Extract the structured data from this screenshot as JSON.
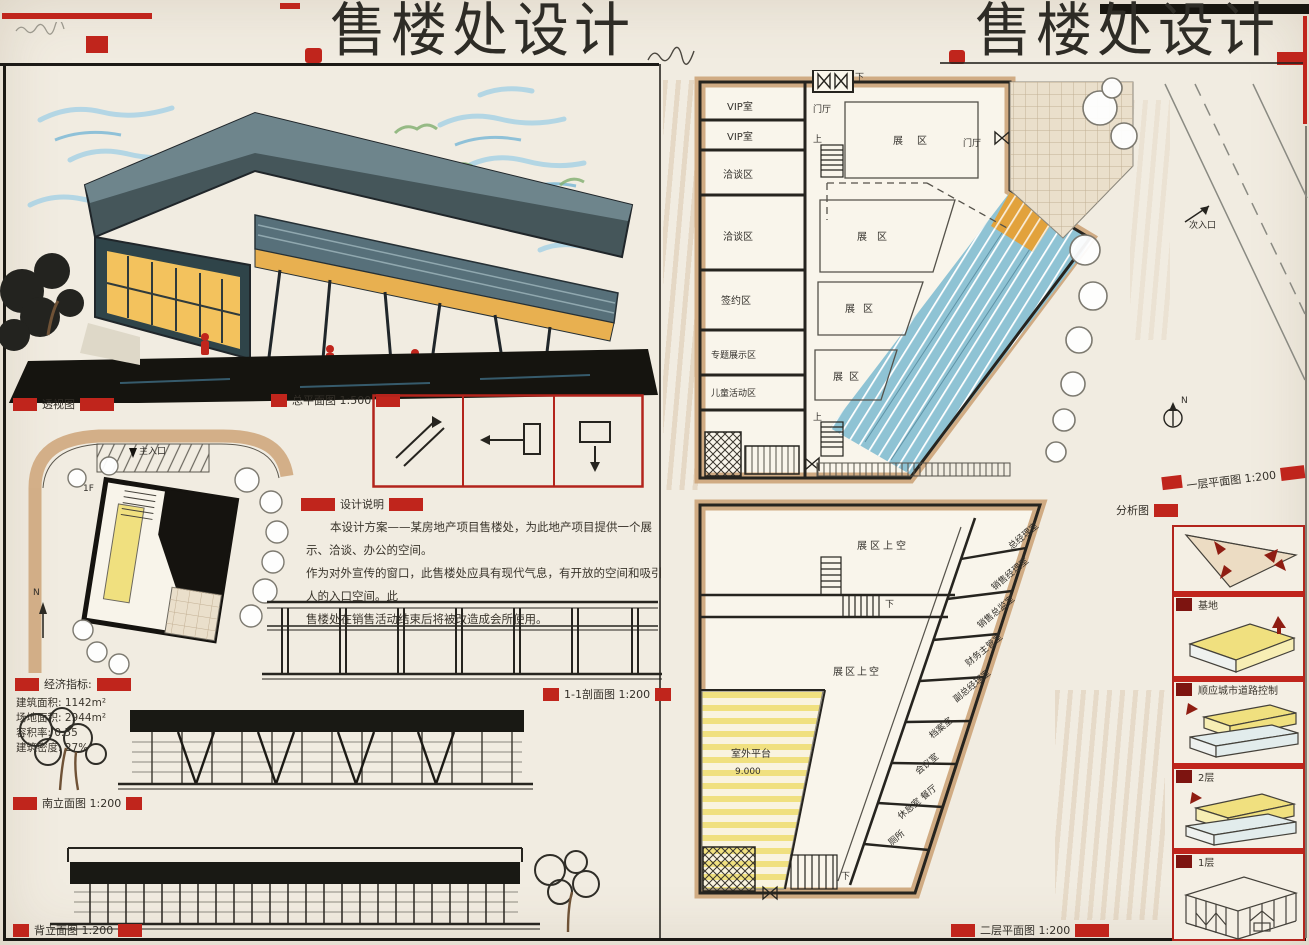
{
  "board": {
    "title_left": "售楼处设计",
    "title_right": "售楼处设计"
  },
  "labels": {
    "perspective": "透视图",
    "site_plan": "总平面图 1:500",
    "design_notes": "设计说明",
    "section_1_1": "1-1剖面图 1:200",
    "south_elevation": "南立面图 1:200",
    "back_elevation": "背立面图 1:200",
    "first_floor_plan": "一层平面图 1:200",
    "second_floor_plan": "二层平面图 1:200",
    "analysis": "分析图"
  },
  "design_notes": {
    "line1": "本设计方案——某房地产项目售楼处，为此地产项目提供一个展示、洽谈、办公的空间。",
    "line2": "作为对外宣传的窗口，此售楼处应具有现代气息，有开放的空间和吸引人的入口空间。此",
    "line3": "售楼处在销售活动结束后将被改造成会所使用。"
  },
  "economic_indicators": {
    "title": "经济指标:",
    "items": [
      "建筑面积: 1142m²",
      "场地面积: 2944m²",
      "容积率: 0.55",
      "建筑密度: 27%"
    ]
  },
  "site_plan": {
    "main_entrance": "主入口",
    "north": "N",
    "floor_tag": "1F"
  },
  "floor1": {
    "rooms": [
      "VIP室",
      "VIP室",
      "洽谈区",
      "洽谈区",
      "签约区",
      "专题展示区",
      "儿童活动区"
    ],
    "zones": [
      "展区",
      "展区",
      "展区",
      "展区"
    ],
    "lobby_a": "门厅",
    "lobby_b": "门厅",
    "up_a": "上",
    "up_b": "上",
    "down": "下",
    "secondary_entrance": "次入口"
  },
  "floor2": {
    "void_a": "展区上空",
    "void_b": "展区上空",
    "terrace": "室外平台",
    "terrace_level": "9.000",
    "down_a": "下",
    "down_b": "下",
    "offices": [
      "总经理室",
      "销售经理室",
      "销售总监室",
      "财务主管室",
      "副总经理室",
      "档案室",
      "会议室",
      "休息室 餐厅",
      "厕所"
    ]
  },
  "analysis": {
    "captions": [
      "基地",
      "顺应城市道路控制",
      "2层",
      "1层"
    ]
  }
}
